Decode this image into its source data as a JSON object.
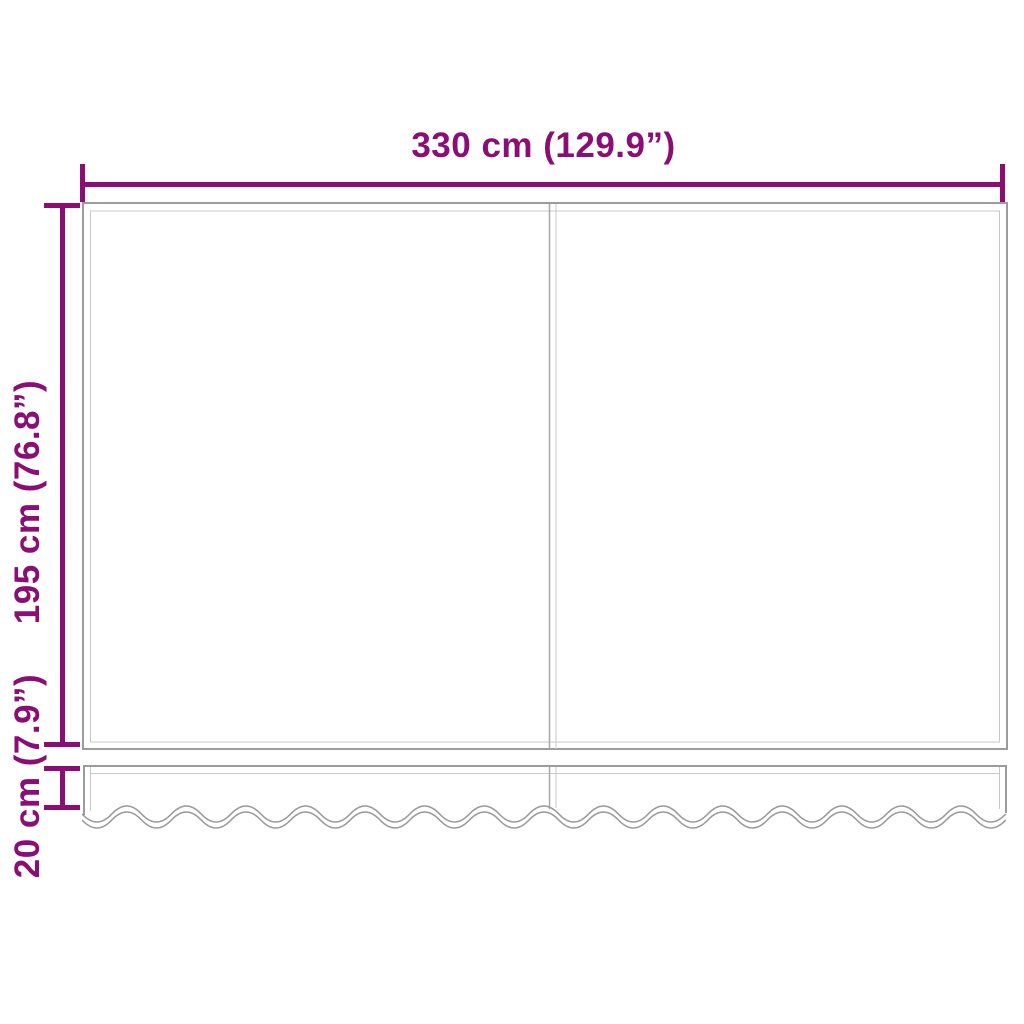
{
  "diagram": {
    "labels": {
      "width": "330 cm (129.9”)",
      "height": "195 cm (76.8”)",
      "valance_height": "20 cm (7.9”)"
    },
    "colors": {
      "dimension_accent": "#8A0E73",
      "outline_dark": "#9C9C9C",
      "outline_light": "#C9C9C9",
      "background": "#FFFFFF"
    }
  }
}
